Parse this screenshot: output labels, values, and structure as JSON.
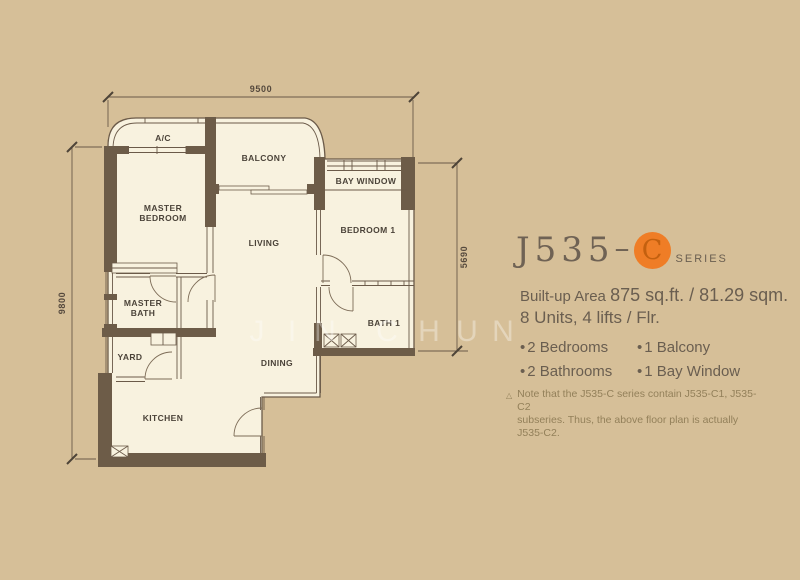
{
  "dimensions": {
    "top": "9500",
    "left": "9800",
    "right": "5690"
  },
  "rooms": {
    "ac": "A/C",
    "balcony": "BALCONY",
    "bay_window": "BAY WINDOW",
    "master_bedroom_1": "MASTER",
    "master_bedroom_2": "BEDROOM",
    "living": "LIVING",
    "bedroom1": "BEDROOM 1",
    "master_bath_1": "MASTER",
    "master_bath_2": "BATH",
    "bath1": "BATH 1",
    "yard": "YARD",
    "dining": "DINING",
    "kitchen": "KITCHEN"
  },
  "watermark": {
    "letters": [
      "J",
      "I",
      "N",
      "C",
      "H",
      "U",
      "N"
    ]
  },
  "info": {
    "title_main": "J535",
    "title_dash": "–",
    "series_letter": "C",
    "series_label": "SERIES",
    "builtup_prefix": "Built-up Area",
    "builtup_value": "875 sq.ft. / 81.29 sqm.",
    "units_line": "8 Units, 4 lifts / Flr.",
    "bullet": "•",
    "features": [
      "2 Bedrooms",
      "1 Balcony",
      "2 Bathrooms",
      "1 Bay Window"
    ],
    "note_symbol": "△",
    "note_line1": "Note that the J535-C series contain J535-C1, J535-C2",
    "note_line2": "subseries. Thus, the above floor plan is actually J535-C2."
  },
  "colors": {
    "background": "#d6bf98",
    "floor": "#f8f2df",
    "wall": "#6d5c48",
    "accent_orange": "#ef7d26",
    "panel_text": "#6a5e50",
    "note_text": "#93805a"
  }
}
